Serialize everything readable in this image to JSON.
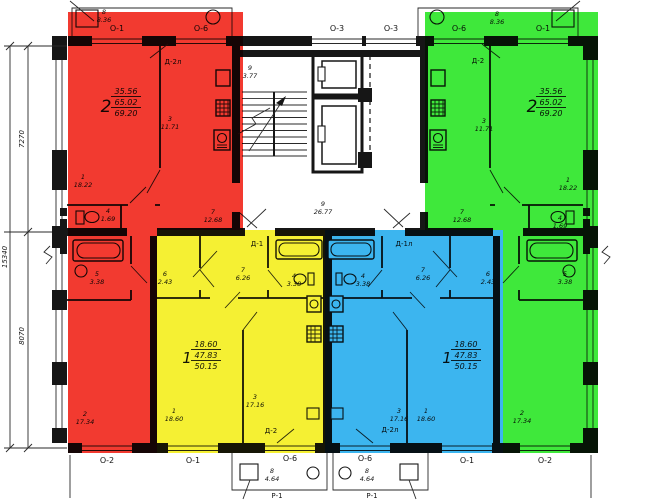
{
  "plan": {
    "axes_top": [
      "О-1",
      "О-6",
      "О-3",
      "О-3",
      "О-6",
      "О-1"
    ],
    "axes_bottom": [
      "О-2",
      "О-1",
      "О-6",
      "О-6",
      "О-1",
      "О-2"
    ],
    "dimensions": {
      "upper": "7270",
      "lower": "8070",
      "total": "15340"
    },
    "doors": {
      "top_left": "Д-2л",
      "top_right": "Д-2",
      "entry_left": "Д-1",
      "entry_right": "Д-1л",
      "bottom_left": "Д-2",
      "bottom_right": "Д-2л"
    },
    "railing_label": "Р-1",
    "core": {
      "stair": {
        "n": "9",
        "a": "3.77"
      },
      "lobby": {
        "n": "9",
        "a": "26.77"
      }
    },
    "balcony_top": {
      "n": "8",
      "a": "8.36"
    },
    "balcony_bottom": {
      "n": "8",
      "a": "4.64"
    },
    "apartments": {
      "red": {
        "type": "2",
        "living": "35.56",
        "area": "65.02",
        "total": "69.20",
        "rooms": [
          {
            "n": "1",
            "a": "18.22"
          },
          {
            "n": "2",
            "a": "17.34"
          },
          {
            "n": "3",
            "a": "11.71"
          },
          {
            "n": "4",
            "a": "1.69"
          },
          {
            "n": "5",
            "a": "3.38"
          },
          {
            "n": "7",
            "a": "12.68"
          }
        ]
      },
      "green": {
        "type": "2",
        "living": "35.56",
        "area": "65.02",
        "total": "69.20",
        "rooms": [
          {
            "n": "1",
            "a": "18.22"
          },
          {
            "n": "2",
            "a": "17.34"
          },
          {
            "n": "3",
            "a": "11.71"
          },
          {
            "n": "4",
            "a": "1.69"
          },
          {
            "n": "5",
            "a": "3.38"
          },
          {
            "n": "7",
            "a": "12.68"
          }
        ]
      },
      "yellow": {
        "type": "1",
        "living": "18.60",
        "area": "47.83",
        "total": "50.15",
        "rooms": [
          {
            "n": "1",
            "a": "18.60"
          },
          {
            "n": "3",
            "a": "17.16"
          },
          {
            "n": "4",
            "a": "3.38"
          },
          {
            "n": "6",
            "a": "2.43"
          },
          {
            "n": "7",
            "a": "6.26"
          }
        ]
      },
      "blue": {
        "type": "1",
        "living": "18.60",
        "area": "47.83",
        "total": "50.15",
        "rooms": [
          {
            "n": "1",
            "a": "18.60"
          },
          {
            "n": "3",
            "a": "17.16"
          },
          {
            "n": "4",
            "a": "3.38"
          },
          {
            "n": "6",
            "a": "2.43"
          },
          {
            "n": "7",
            "a": "6.26"
          }
        ]
      }
    },
    "colors": {
      "red": "#f23a30",
      "yellow": "#f5f033",
      "blue": "#3cb5ef",
      "green": "#3fe83b"
    }
  }
}
